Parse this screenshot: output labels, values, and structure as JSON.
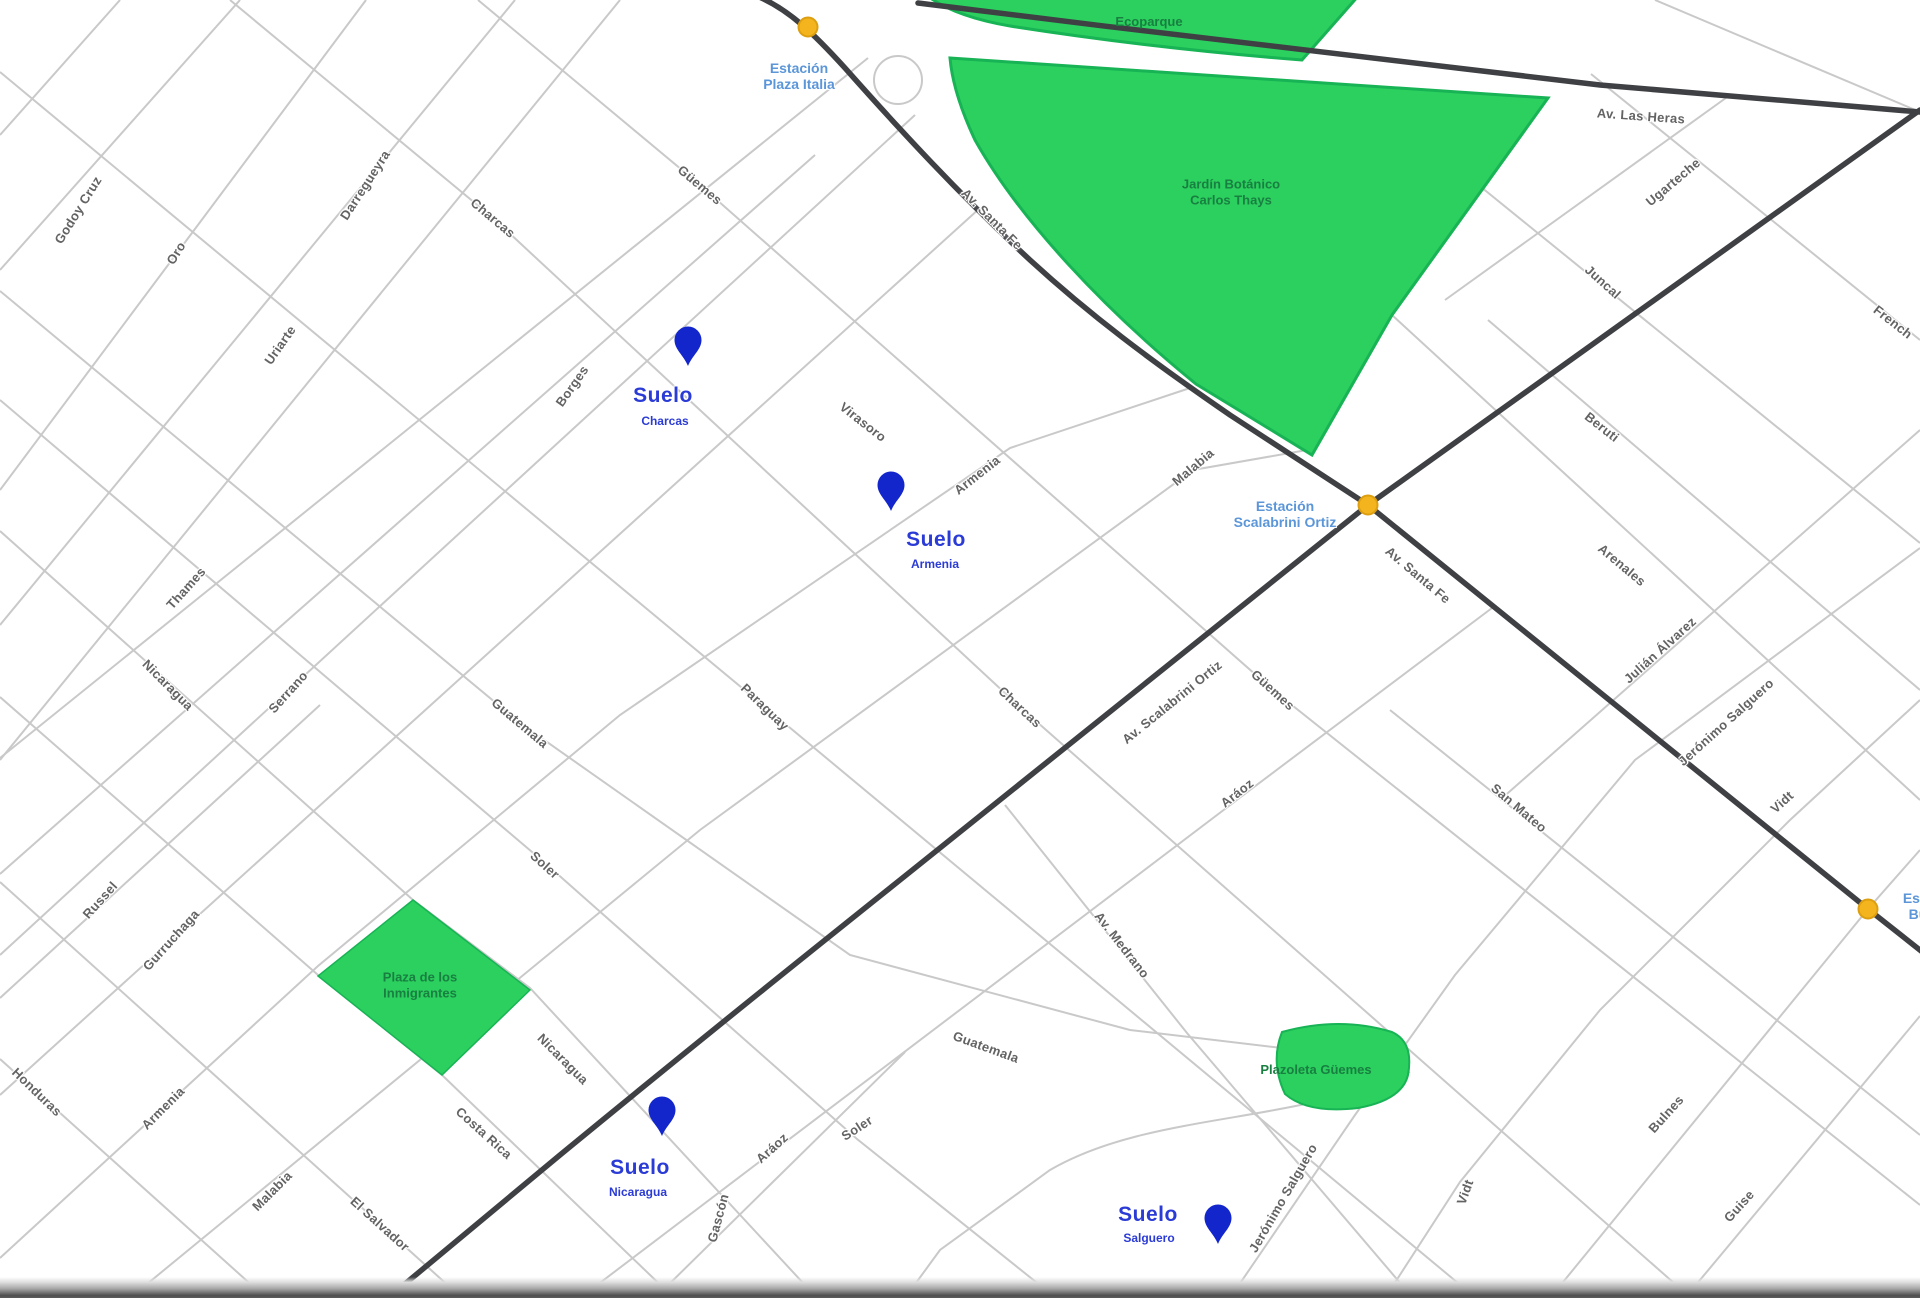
{
  "map_title": "Palermo map with Suelo locations",
  "colors": {
    "background": "#ffffff",
    "street_line": "#c9c9c9",
    "avenue_line": "#3e4044",
    "park_fill": "#2cd05e",
    "park_stroke": "#17b355",
    "park_label": "#187f41",
    "station_dot": "#f3b41d",
    "station_label": "#5b96d9",
    "suelo_blue": "#2b3bd5",
    "pin_blue": "#1226cc"
  },
  "parks": [
    {
      "name": "Ecoparque",
      "label_lines": [
        "Ecoparque"
      ],
      "x": 1149,
      "y": 22
    },
    {
      "name": "Jardín Botánico Carlos Thays",
      "label_lines": [
        "Jardín Botánico",
        "Carlos Thays"
      ],
      "x": 1231,
      "y": 192
    },
    {
      "name": "Plaza de los Inmigrantes",
      "label_lines": [
        "Plaza de los",
        "Inmigrantes"
      ],
      "x": 420,
      "y": 985
    },
    {
      "name": "Plazoleta Güemes",
      "label_lines": [
        "Plazoleta Güemes"
      ],
      "x": 1316,
      "y": 1070
    }
  ],
  "stations": [
    {
      "name": "Estación Plaza Italia",
      "label_lines": [
        "Estación",
        "Plaza Italia"
      ],
      "dot_x": 808,
      "dot_y": 27,
      "label_x": 799,
      "label_y": 76
    },
    {
      "name": "Estación Scalabrini Ortiz",
      "label_lines": [
        "Estación",
        "Scalabrini Ortiz"
      ],
      "dot_x": 1368,
      "dot_y": 505,
      "label_x": 1285,
      "label_y": 514
    },
    {
      "name": "Estación Bulnes",
      "label_lines": [
        "Estación",
        "Bulnes"
      ],
      "dot_x": 1868,
      "dot_y": 909,
      "label_x": 1932,
      "label_y": 906
    }
  ],
  "suelo_markers": [
    {
      "brand": "Suelo",
      "location": "Charcas",
      "pin_x": 688,
      "pin_y": 367,
      "logo_x": 663,
      "logo_y": 396,
      "sub_x": 665,
      "sub_y": 421
    },
    {
      "brand": "Suelo",
      "location": "Armenia",
      "pin_x": 891,
      "pin_y": 512,
      "logo_x": 936,
      "logo_y": 540,
      "sub_x": 935,
      "sub_y": 564
    },
    {
      "brand": "Suelo",
      "location": "Nicaragua",
      "pin_x": 662,
      "pin_y": 1137,
      "logo_x": 640,
      "logo_y": 1168,
      "sub_x": 638,
      "sub_y": 1192
    },
    {
      "brand": "Suelo",
      "location": "Salguero",
      "pin_x": 1218,
      "pin_y": 1245,
      "logo_x": 1148,
      "logo_y": 1215,
      "sub_x": 1149,
      "sub_y": 1238
    }
  ],
  "street_labels": [
    {
      "t": "Godoy Cruz",
      "x": 78,
      "y": 210,
      "r": -58
    },
    {
      "t": "Oro",
      "x": 176,
      "y": 253,
      "r": -58
    },
    {
      "t": "Darregueyra",
      "x": 365,
      "y": 185,
      "r": -57
    },
    {
      "t": "Uriarte",
      "x": 280,
      "y": 345,
      "r": -55
    },
    {
      "t": "Borges",
      "x": 572,
      "y": 386,
      "r": -55
    },
    {
      "t": "Charcas",
      "x": 493,
      "y": 218,
      "r": 40
    },
    {
      "t": "Güemes",
      "x": 700,
      "y": 185,
      "r": 40
    },
    {
      "t": "Thames",
      "x": 186,
      "y": 588,
      "r": -48
    },
    {
      "t": "Serrano",
      "x": 288,
      "y": 692,
      "r": -48
    },
    {
      "t": "Russel",
      "x": 100,
      "y": 900,
      "r": -48
    },
    {
      "t": "Gurruchaga",
      "x": 171,
      "y": 940,
      "r": -48
    },
    {
      "t": "Nicaragua",
      "x": 168,
      "y": 685,
      "r": 45
    },
    {
      "t": "Honduras",
      "x": 37,
      "y": 1092,
      "r": 44
    },
    {
      "t": "Armenia",
      "x": 163,
      "y": 1108,
      "r": -45
    },
    {
      "t": "Malabia",
      "x": 272,
      "y": 1191,
      "r": -45
    },
    {
      "t": "El Salvador",
      "x": 380,
      "y": 1224,
      "r": 42
    },
    {
      "t": "Costa Rica",
      "x": 484,
      "y": 1133,
      "r": 42
    },
    {
      "t": "Nicaragua",
      "x": 563,
      "y": 1059,
      "r": 45
    },
    {
      "t": "Guatemala",
      "x": 520,
      "y": 723,
      "r": 40
    },
    {
      "t": "Soler",
      "x": 545,
      "y": 865,
      "r": 42
    },
    {
      "t": "Paraguay",
      "x": 765,
      "y": 707,
      "r": 44
    },
    {
      "t": "Virasoro",
      "x": 863,
      "y": 422,
      "r": 38
    },
    {
      "t": "Armenia",
      "x": 977,
      "y": 475,
      "r": -38
    },
    {
      "t": "Malabia",
      "x": 1193,
      "y": 467,
      "r": -40
    },
    {
      "t": "Charcas",
      "x": 1020,
      "y": 707,
      "r": 43
    },
    {
      "t": "Güemes",
      "x": 1273,
      "y": 690,
      "r": 42
    },
    {
      "t": "Aráoz",
      "x": 1237,
      "y": 793,
      "r": -38
    },
    {
      "t": "Aráoz",
      "x": 772,
      "y": 1148,
      "r": -42
    },
    {
      "t": "Soler",
      "x": 857,
      "y": 1128,
      "r": -33
    },
    {
      "t": "Gascón",
      "x": 718,
      "y": 1218,
      "r": -75
    },
    {
      "t": "Guatemala",
      "x": 986,
      "y": 1047,
      "r": 20
    },
    {
      "t": "Av. Medrano",
      "x": 1122,
      "y": 945,
      "r": 52
    },
    {
      "t": "Av. Scalabrini Ortiz",
      "x": 1172,
      "y": 702,
      "r": -39
    },
    {
      "t": "San Mateo",
      "x": 1519,
      "y": 808,
      "r": 40
    },
    {
      "t": "Jerónimo Salguero",
      "x": 1726,
      "y": 722,
      "r": -42
    },
    {
      "t": "Julián Álvarez",
      "x": 1660,
      "y": 650,
      "r": -42
    },
    {
      "t": "Arenales",
      "x": 1622,
      "y": 565,
      "r": 40
    },
    {
      "t": "Beruti",
      "x": 1602,
      "y": 427,
      "r": 38
    },
    {
      "t": "Juncal",
      "x": 1603,
      "y": 282,
      "r": 42
    },
    {
      "t": "Ugarteche",
      "x": 1673,
      "y": 182,
      "r": -40
    },
    {
      "t": "French",
      "x": 1893,
      "y": 322,
      "r": 38
    },
    {
      "t": "Vidt",
      "x": 1782,
      "y": 802,
      "r": -42
    },
    {
      "t": "Vidt",
      "x": 1465,
      "y": 1192,
      "r": -70
    },
    {
      "t": "Bulnes",
      "x": 1666,
      "y": 1114,
      "r": -48
    },
    {
      "t": "Guise",
      "x": 1739,
      "y": 1206,
      "r": -48
    },
    {
      "t": "Jerónimo Salguero",
      "x": 1283,
      "y": 1198,
      "r": -60
    },
    {
      "t": "Av. Las Heras",
      "x": 1641,
      "y": 116,
      "r": 4
    },
    {
      "t": "Av. Santa Fe",
      "x": 992,
      "y": 219,
      "r": 45
    },
    {
      "t": "Av. Santa Fe",
      "x": 1418,
      "y": 575,
      "r": 40
    }
  ]
}
